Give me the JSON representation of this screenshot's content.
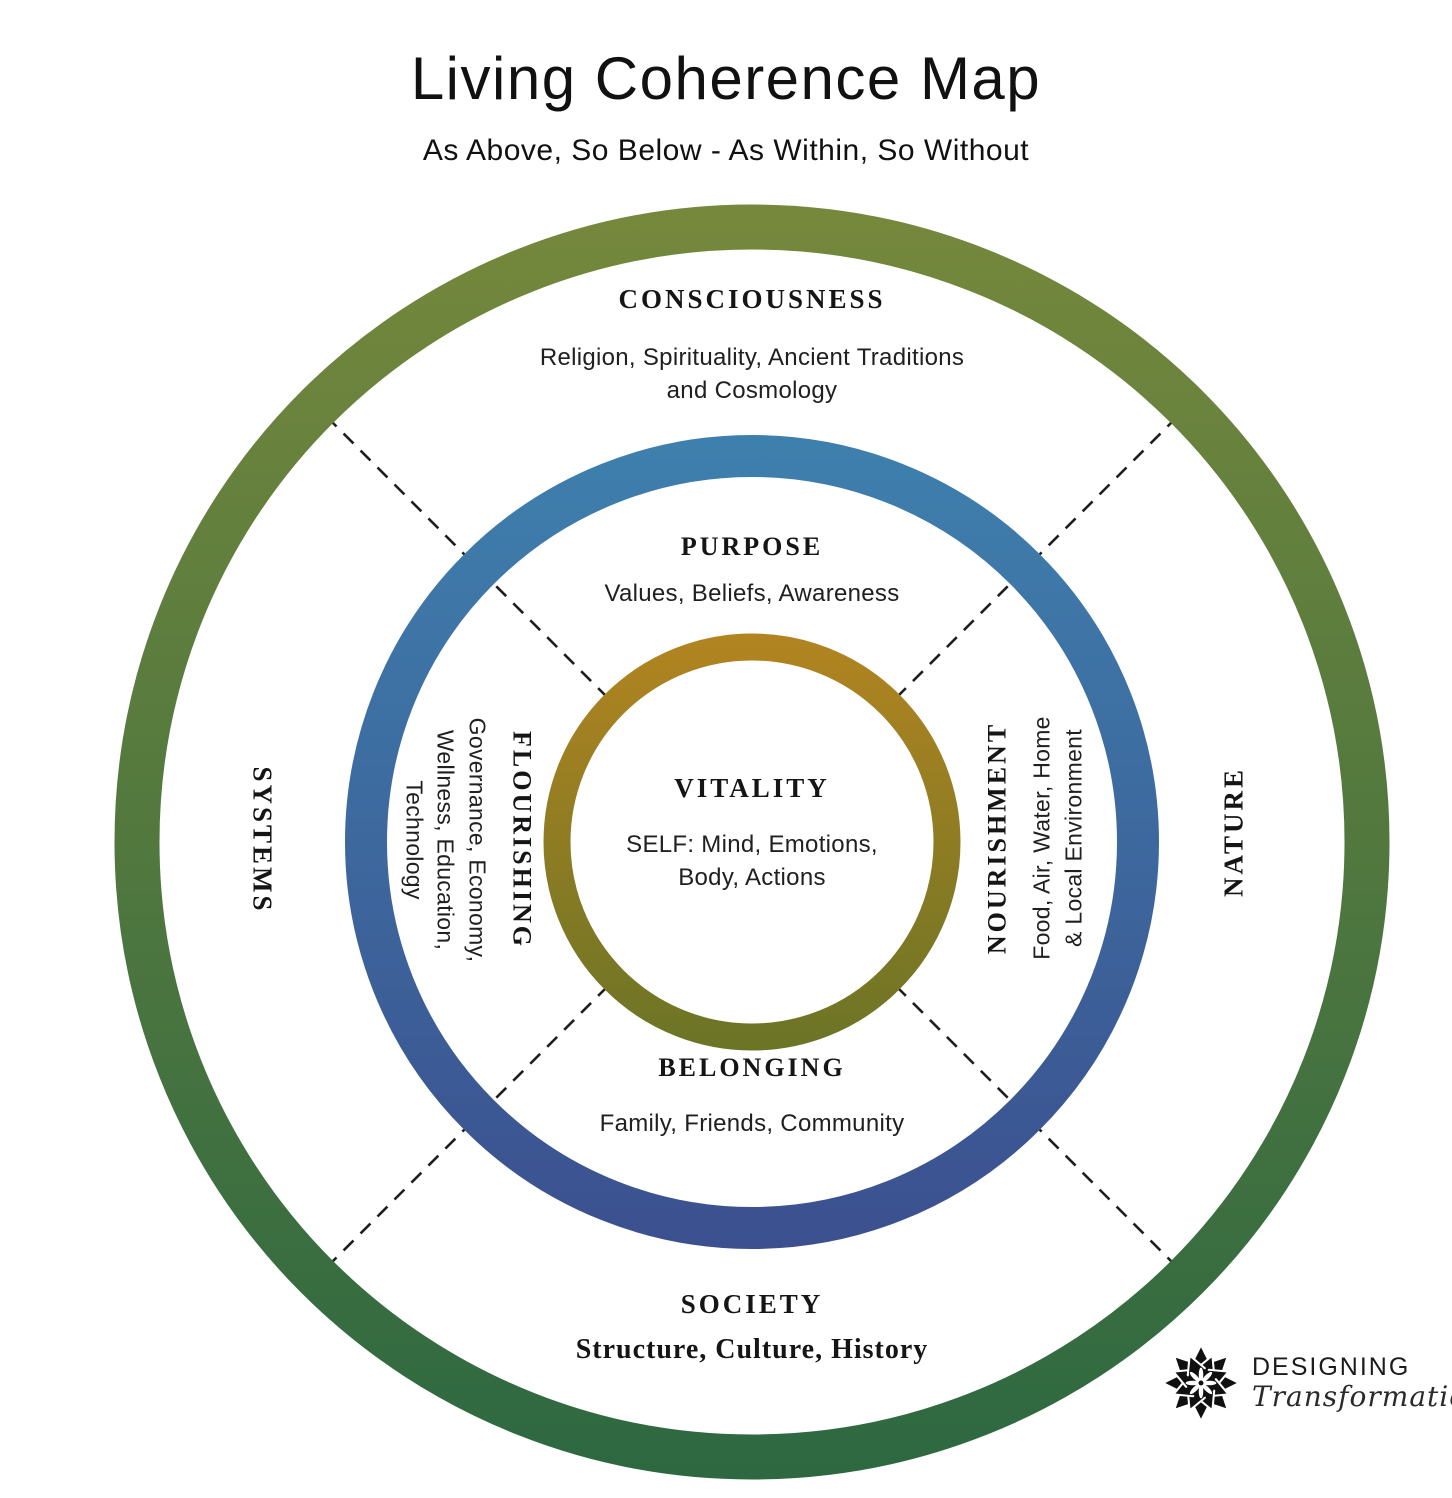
{
  "title": "Living Coherence Map",
  "subtitle": "As Above, So Below - As Within, So Without",
  "center_circle": {
    "label": "VITALITY",
    "detail_lines": [
      "SELF: Mind, Emotions,",
      "Body, Actions"
    ]
  },
  "middle_ring": {
    "top": {
      "label": "PURPOSE",
      "detail": "Values, Beliefs, Awareness"
    },
    "left": {
      "label": "FLOURISHING",
      "detail_lines": [
        "Governance, Economy,",
        "Wellness, Education,",
        "Technology"
      ]
    },
    "right": {
      "label": "NOURISHMENT",
      "detail_lines": [
        "Food, Air, Water, Home",
        "& Local Environment"
      ]
    },
    "bottom": {
      "label": "BELONGING",
      "detail": "Family, Friends, Community"
    }
  },
  "outer_ring": {
    "top": {
      "label": "CONSCIOUSNESS",
      "detail_lines": [
        "Religion, Spirituality, Ancient Traditions",
        "and Cosmology"
      ]
    },
    "left": {
      "label": "SYSTEMS"
    },
    "right": {
      "label": "NATURE"
    },
    "bottom": {
      "label": "SOCIETY",
      "detail": "Structure, Culture, History"
    }
  },
  "logo": {
    "name_caps": "DESIGNING",
    "name_script": "Transformation"
  },
  "colors": {
    "outer_ring_top": "#76883c",
    "outer_ring_bottom": "#2d6841",
    "middle_ring_top": "#3e80ad",
    "middle_ring_bottom": "#3c508f",
    "inner_ring_top": "#b28420",
    "inner_ring_bottom": "#6b7426",
    "divider_line": "#1f1f1f",
    "text": "#1a1a1a"
  }
}
